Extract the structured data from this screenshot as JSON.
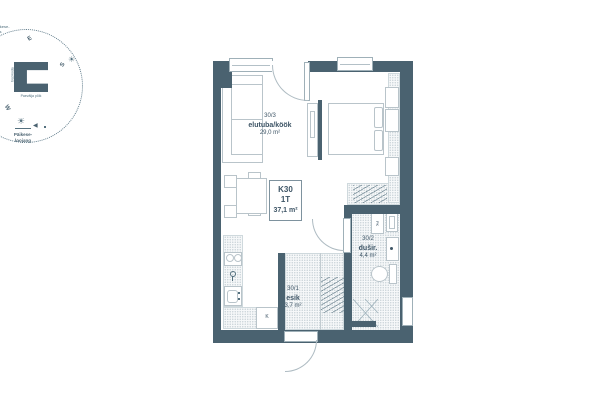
{
  "colors": {
    "wall": "#4a6270",
    "line": "#b9c4ca",
    "text": "#3e5566",
    "accent": "#54707e"
  },
  "compass": {
    "sunrise_label_line1": "Päikese-",
    "sunrise_label_line2": "tõus",
    "sunset_label_line1": "Päikese-",
    "sunset_label_line2": "loojang",
    "direction_east": "E",
    "direction_south": "S",
    "direction_west": "W",
    "sun_icon": "☀",
    "sunset_icon": "☀",
    "arrow_icon": "◀",
    "building_label": "Paevälja põik",
    "stair_label": "trepikoda"
  },
  "unit": {
    "code": "K30",
    "type": "1T",
    "area": "37,1 m²"
  },
  "rooms": {
    "living": {
      "number": "30/3",
      "name": "elutuba/köök",
      "area": "29,0 m²"
    },
    "shower": {
      "number": "30/2",
      "name": "dušir.",
      "area": "4,4 m²"
    },
    "hall": {
      "number": "30/1",
      "name": "esik",
      "area": "3,7 m²"
    }
  },
  "appliances": {
    "fridge": "K",
    "washer": "PK"
  }
}
